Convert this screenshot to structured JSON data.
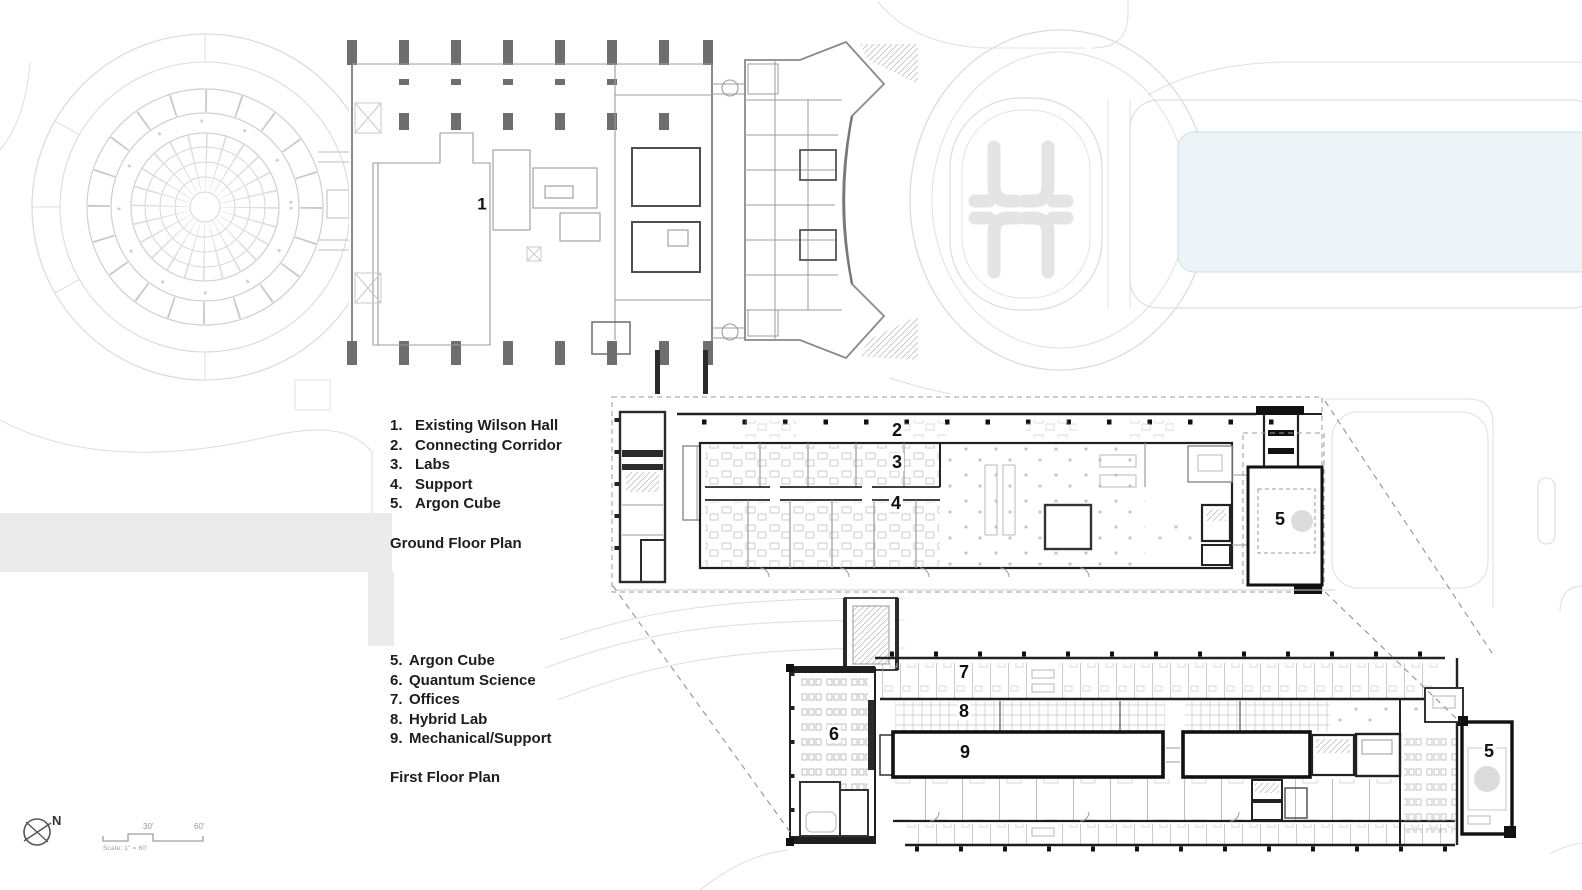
{
  "sheet": {
    "type": "architectural site / floor plan drawing"
  },
  "colors": {
    "pond_fill": "#edf4f8",
    "pond_border": "#cbdde4",
    "site_line": "#dcdcdc",
    "path_band": "#ebebeb",
    "logo_grey": "#e4e4e4",
    "wall_dark": "#1f1f1f",
    "wall_grey": "#8a8a8a",
    "text": "#1d1d1d"
  },
  "ground_floor": {
    "title": "Ground Floor Plan",
    "legend": [
      {
        "num": "1.",
        "label": "Existing Wilson Hall"
      },
      {
        "num": "2.",
        "label": "Connecting Corridor"
      },
      {
        "num": "3.",
        "label": "Labs"
      },
      {
        "num": "4.",
        "label": "Support"
      },
      {
        "num": "5.",
        "label": "Argon Cube"
      }
    ],
    "markers": {
      "m1": "1",
      "m2": "2",
      "m3": "3",
      "m4": "4",
      "m5": "5"
    }
  },
  "first_floor": {
    "title": "First Floor Plan",
    "legend": [
      {
        "num": "5.",
        "label": "Argon Cube"
      },
      {
        "num": "6.",
        "label": "Quantum Science"
      },
      {
        "num": "7.",
        "label": "Offices"
      },
      {
        "num": "8.",
        "label": "Hybrid Lab"
      },
      {
        "num": "9.",
        "label": "Mechanical/Support"
      }
    ],
    "markers": {
      "m5": "5",
      "m6": "6",
      "m7": "7",
      "m8": "8",
      "m9": "9"
    }
  },
  "compass": {
    "north_label": "N"
  },
  "scale_bar": {
    "mid_label": "30'",
    "end_label": "60'",
    "caption": "Scale: 1\" = 60'"
  }
}
